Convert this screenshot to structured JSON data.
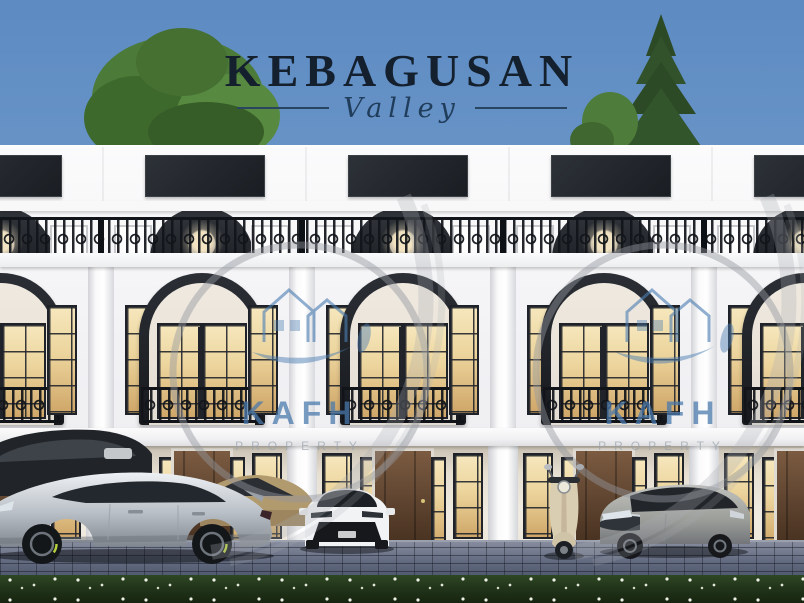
{
  "branding": {
    "title": "KEBAGUSAN",
    "subtitle": "Valley"
  },
  "watermark": {
    "brand": "KAFH",
    "tagline": "PROPERTY"
  },
  "scene": {
    "type": "residential-townhouse-exterior-rendering",
    "objects": [
      "leafy-tree",
      "pine-tree",
      "townhouse-row",
      "rooftop-iron-railing",
      "arched-window",
      "juliet-balcony",
      "wood-entry-door",
      "silver-sports-sedan",
      "dark-suv",
      "tan-car",
      "white-hatchback",
      "scooter",
      "gray-sedan",
      "cobblestone-driveway",
      "flower-grass-strip"
    ],
    "colors": {
      "sky_top": "#5d8bc2",
      "sky_bottom": "#93b4da",
      "title_text": "#14202e",
      "facade_white": "#f1f1f4",
      "accent_dark": "#22262b",
      "window_glow": "#ecd49c",
      "door_brown": "#5d432f",
      "railing_black": "#111419",
      "pavement_gray": "#646c82",
      "grass_green": "#22351b",
      "watermark_blue": "#4d7eb2",
      "watermark_gray": "#98a2ab"
    }
  }
}
